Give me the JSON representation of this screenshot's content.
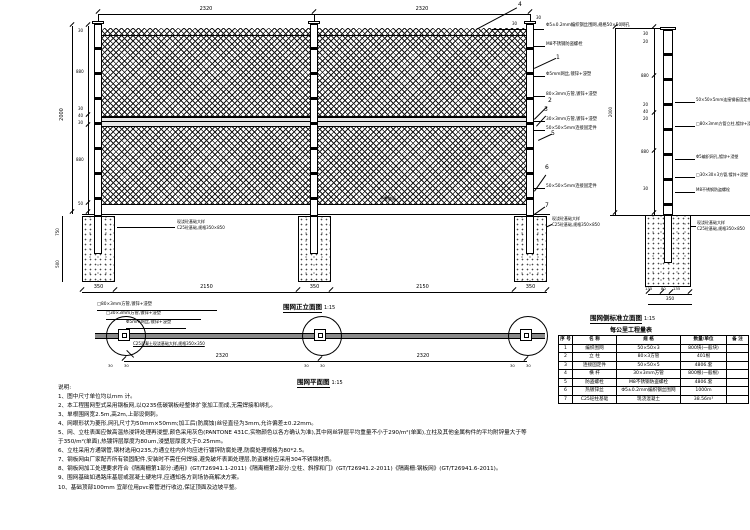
{
  "elevation": {
    "caption": "围网正立面图",
    "scale": "1:15",
    "ground_label": "平整路面",
    "dims_top": [
      "2320",
      "2320"
    ],
    "dims_top_small": [
      "30",
      "30"
    ],
    "overall_height": "2000",
    "left_chain": [
      "30",
      "880",
      "30",
      "40",
      "30",
      "880",
      "50"
    ],
    "footing_depth": [
      "750",
      "500"
    ],
    "dims_bottom": [
      "350",
      "2150",
      "350",
      "2150",
      "350"
    ],
    "balloons": {
      "b1": "1",
      "b2": "2",
      "b3": "3",
      "b4": "4",
      "b5": "5",
      "b6": "6",
      "b7": "7"
    },
    "callouts": [
      "Φ5±0.2mm编织钢丝围网,规格50×50网孔",
      "M8不锈钢防盗螺栓",
      "Φ5mm网丝,镀锌+浸塑",
      "80×3mm方管,镀锌+浸塑",
      "30×3mm方管,镀锌+浸塑",
      "50×50×5mm连接固定件",
      "50×50×5mm连接固定件"
    ],
    "footing_label": [
      "现浇砼基础大样",
      "C25砼基础,规格350×850"
    ]
  },
  "side": {
    "caption": "围网侧标准立面图",
    "scale": "1:15",
    "overall_height": "2000",
    "left_chain": [
      "30",
      "20",
      "880",
      "20",
      "40",
      "20",
      "880",
      "30"
    ],
    "dims_bottom": [
      "135",
      "80",
      "135"
    ],
    "dim_bottom_total": "350",
    "callouts": [
      "50×50×5mm连接钢板固定件,镀锌+浸塑",
      "□80×3mm方管立柱,镀锌+浸塑",
      "Φ5编织网孔,镀锌+浸塑",
      "□30×30×3方管,镀锌+浸塑",
      "M8不锈钢防盗螺栓"
    ],
    "footing_label": [
      "现浇砼基础大样",
      "C25砼基础,规格350×850"
    ]
  },
  "plan": {
    "caption": "围网平面图",
    "scale": "1:15",
    "dims_spans": [
      "2320",
      "2320"
    ],
    "dims_small": [
      "30",
      "30",
      "30",
      "30",
      "30",
      "30"
    ],
    "callouts": [
      "□80×3mm方管,镀锌+浸塑",
      "□30×3mm方管,镀锌+浸塑",
      "Φ5mm网丝,镀锌+浸塑"
    ],
    "footing_note": "C25混凝土现浇基础大样,规格350×350"
  },
  "table": {
    "title": "每公里工程量表",
    "headers": [
      "序 号",
      "名  称",
      "规  格",
      "数量/单位",
      "备 注"
    ],
    "rows": [
      [
        "1",
        "编织围网",
        "50×50×3",
        "800块(一般块)",
        ""
      ],
      [
        "2",
        "立  柱",
        "80×3方管",
        "401根",
        ""
      ],
      [
        "3",
        "连接固定件",
        "50×50×5",
        "4806.套",
        ""
      ],
      [
        "4",
        "横  杆",
        "30×3mm方管",
        "800根(一般根)",
        ""
      ],
      [
        "5",
        "防盗螺栓",
        "M8不锈钢防盗螺栓",
        "4806.套",
        ""
      ],
      [
        "6",
        "热镀锌丝",
        "Φ5±0.2mm编织钢丝围网",
        "1000m",
        ""
      ],
      [
        "7",
        "C25砼柱基础",
        "现浇混凝土",
        "38.56m³",
        ""
      ]
    ]
  },
  "notes": {
    "title": "说明:",
    "items": [
      "1、图中尺寸单位均以mm 计。",
      "2、本工程围网型式采用钢板网,以Q235低碳钢板经整体扩张加工而成,无需焊接和绑扎。",
      "3、单根围网宽2.5m,高2m,上部设倒刺。",
      "4、网眼形状为菱形,网孔尺寸为50mm×50mm;加工后(防腐蚀)丝径直径为3mm,允许偏差±0.22mm。",
      "5、网、立柱表面应做高温热浸锌处理再浸塑,颜色采用灰色(PANTONE 431C,实物颜色以各方确认为准),其中网丝锌层平均重量不小于290/m²(单面),立柱及其他金属构件的平均附锌量大于等于350/m²(单面),热镀锌层厚度为80um,浸塑层厚度大于0.25mm。",
      "6、立柱采用方通钢管,钢材选用Q235,方通立柱内外均应进行镀锌防腐处理,防腐处理规格为80*2.5。",
      "7、钢板网由厂家配齐所有锁固配件,安装时不需任何焊接,避免破坏表面处理层,防盗螺栓应采用304不锈钢材质。",
      "8、钢板网加工处理要求符合《隔离栅第1部分:通用》(GT/T26941.1-2011)《隔离栅第2部分:立柱、斜撑和门》(GT/T26941.2-2011)《隔离栅:钢板网》(GT/T26941.6-2011)。",
      "9、围网基础如遇路床基层或混凝土硬地坪,应通知各方到场协商解决方案。",
      "10、基础顶部100mm 宜部位用pvc套管进行收边,保证顶面及边坡平整。"
    ]
  }
}
